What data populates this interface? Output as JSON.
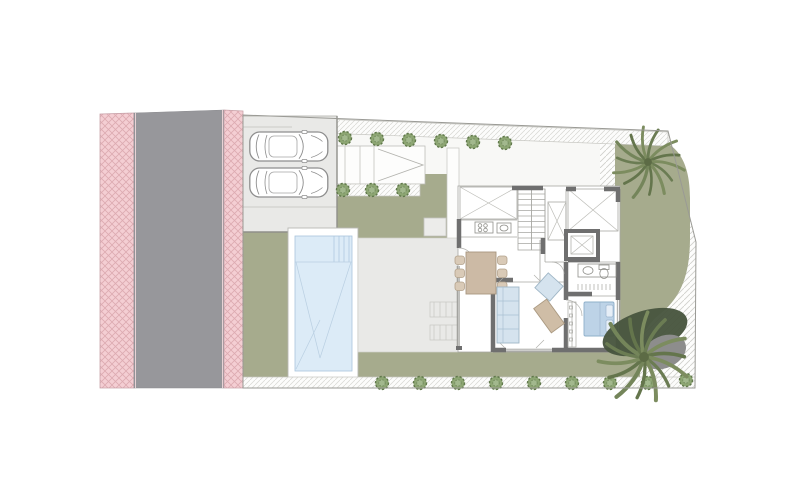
{
  "description": "Architectural site plan of a villa plot: street with sidewalks at left, parking pad with two cars, entrance ramp, swimming pool, terrace, single-storey house floor plan, lawn garden with two palm trees and hedge bushes",
  "inventory": {
    "cars": 2,
    "palm_trees": 2,
    "bushes_top_row": 6,
    "bushes_middle_row": 3,
    "bushes_bottom_row": 9,
    "pools": 1
  },
  "colors": {
    "background": "#ffffff",
    "road": "#97979b",
    "sidewalk_pink": "#f4ced3",
    "sidewalk_hatch": "#dcaab1",
    "plot_base": "#f8f8f6",
    "lawn": "#a6ab8d",
    "terrace": "#e9e9e7",
    "parking_pad": "#e9e9e7",
    "pool_water": "#dcebf7",
    "pool_border": "#ffffff",
    "house_floor": "#ffffff",
    "house_wall": "#6f6f6f",
    "thin_line": "#a7a7a2",
    "furniture_wood": "#ccbaa5",
    "furniture_chair": "#d9cab7",
    "sofa_blue": "#d5e3ee",
    "bed_blue": "#bdd3e7",
    "bush_green": "#8da673",
    "palm_green": "#7c8c5f",
    "palm_green_dark": "#5f7047",
    "shadow_dark_green": "#48553e",
    "shadow_gray": "#8d8d8c",
    "hatch_line": "#cfcfca"
  }
}
